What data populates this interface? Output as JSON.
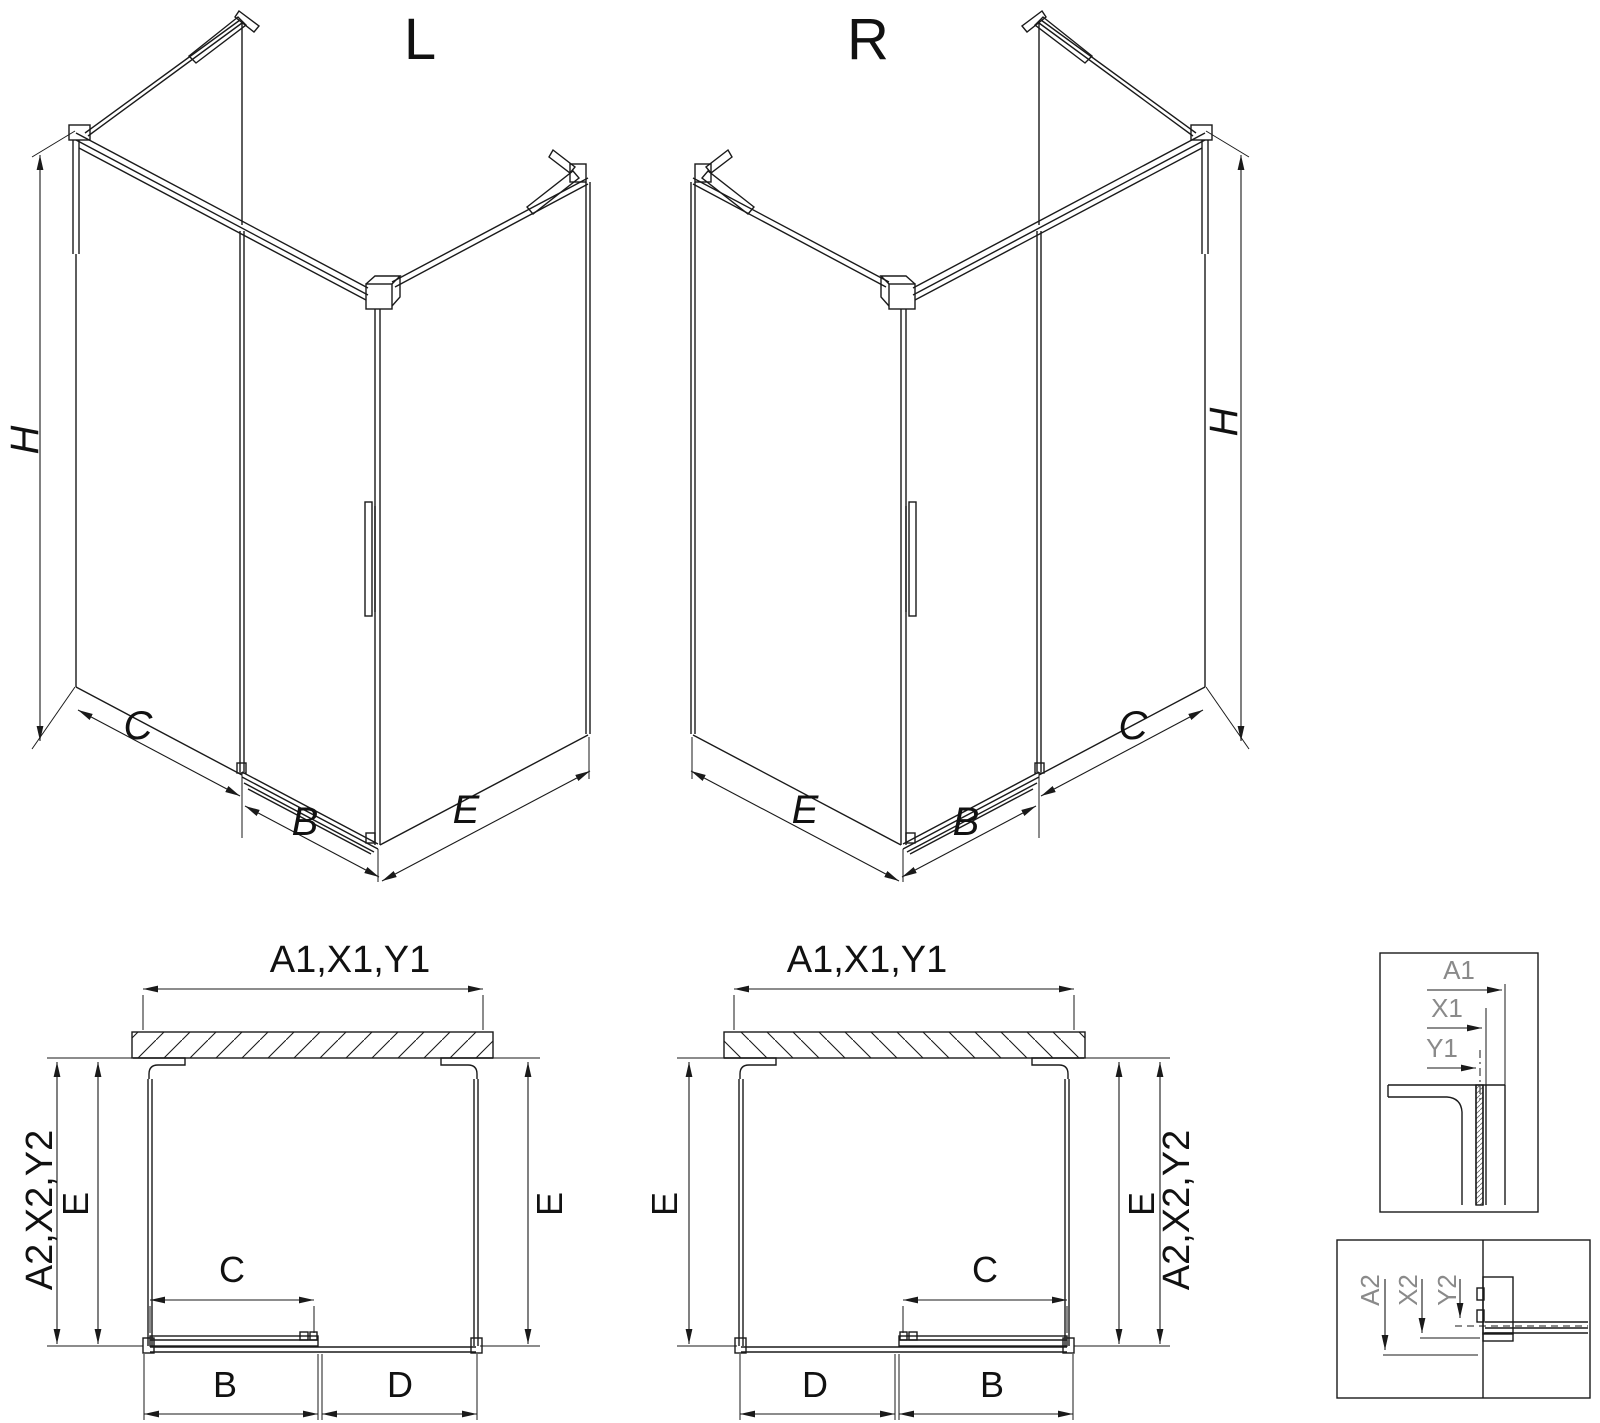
{
  "drawing": {
    "colors": {
      "line": "#1a1a1a",
      "detail_label": "#8a8a8a",
      "background": "#ffffff"
    },
    "views": {
      "iso_left": {
        "label": "L",
        "dim_height": "H",
        "dim_fixed_panel": "C",
        "dim_door": "B",
        "dim_side_panel": "E"
      },
      "iso_right": {
        "label": "R",
        "dim_height": "H",
        "dim_side_panel": "E",
        "dim_door": "B",
        "dim_fixed_panel": "C"
      },
      "plan_left": {
        "dim_width_top": "A1,X1,Y1",
        "dim_depth_side": "A2,X2,Y2",
        "dim_depth_left": "E",
        "dim_depth_right": "E",
        "dim_door_glass": "C",
        "dim_door": "B",
        "dim_opening": "D"
      },
      "plan_middle": {
        "dim_width_top": "A1,X1,Y1",
        "dim_depth_side": "A2,X2,Y2",
        "dim_depth_left": "E",
        "dim_depth_right": "E",
        "dim_door_glass": "C",
        "dim_door": "B",
        "dim_opening": "D"
      },
      "detail_top": {
        "dim_a1": "A1",
        "dim_x1": "X1",
        "dim_y1": "Y1"
      },
      "detail_bottom": {
        "dim_a2": "A2",
        "dim_x2": "X2",
        "dim_y2": "Y2"
      }
    }
  }
}
